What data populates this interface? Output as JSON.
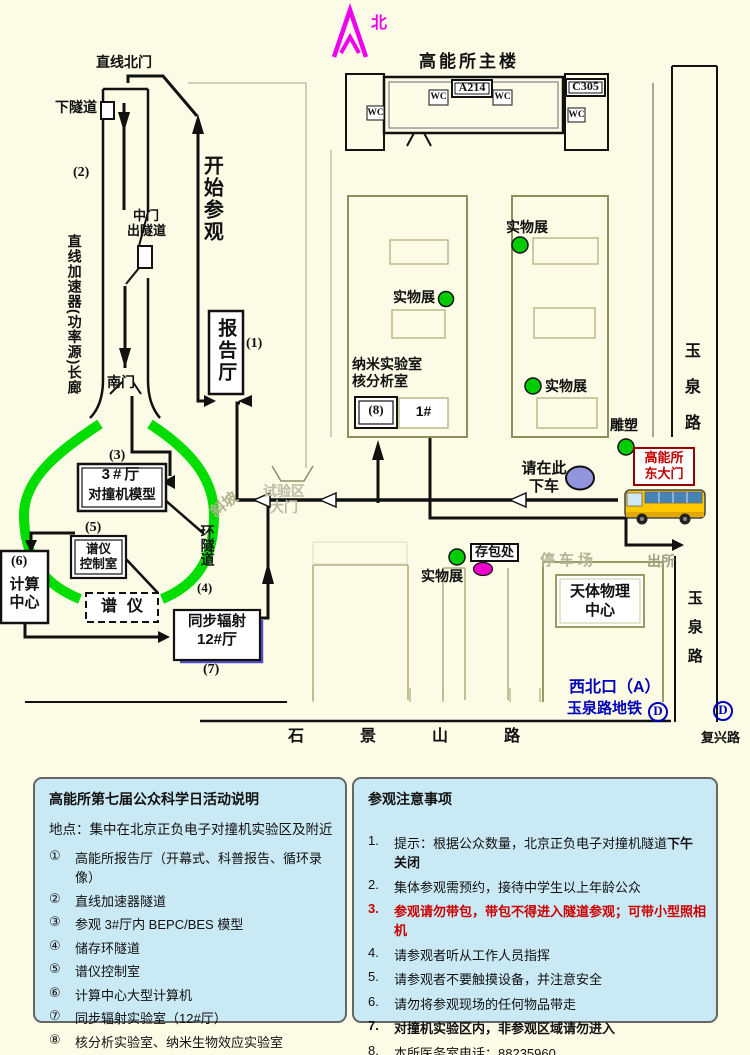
{
  "map": {
    "north": "北",
    "main_building": {
      "title": "高能所主楼",
      "a214": "A214",
      "c305": "C305",
      "wc": "WC"
    },
    "labels": {
      "line_north_gate": "直线北门",
      "down_tunnel": "下隧道",
      "n1": "(1)",
      "n2": "(2)",
      "n3": "(3)",
      "n4": "(4)",
      "n5": "(5)",
      "n6": "(6)",
      "n7": "(7)",
      "n8": "(8)",
      "linac": "直线加速器(功率源)长廊",
      "mid_gate_1": "中门",
      "mid_gate_2": "出隧道",
      "start_visit": "开始参观",
      "south_gate": "南门",
      "report_hall": "报告厅",
      "hall3_1": "3#厅",
      "hall3_2": "对撞机模型",
      "spectro_ctrl_1": "谱仪",
      "spectro_ctrl_2": "控制室",
      "computing_1": "计算",
      "computing_2": "中心",
      "spectrometer": "谱仪",
      "ring_tunnel": "环隧道",
      "sync_1": "同步辐射",
      "sync_2": "12#厅",
      "slope": "斜坡",
      "test_gate_1": "试验区",
      "test_gate_2": "大门",
      "nano_1": "纳米实验室",
      "nano_2": "核分析室",
      "hall_1no": "1#",
      "exhibit": "实物展",
      "sculpture": "雕塑",
      "east_gate_1": "高能所",
      "east_gate_2": "东大门",
      "get_off_1": "请在此",
      "get_off_2": "下车",
      "parking": "停车场",
      "bag_check": "存包处",
      "astro_1": "天体物理",
      "astro_2": "中心",
      "exit_out": "出所",
      "northwest_exit": "西北口（A）",
      "subway": "玉泉路地铁",
      "subway_d": "D",
      "yuquan_road": "玉泉路",
      "shijingshan_road": "石景山路",
      "fuxing_road": "复兴路"
    },
    "colors": {
      "ring_green": "#00DD00",
      "marker_green": "#00CC00",
      "bag_magenta": "#EE00CC",
      "dropoff_blue": "#9394DE",
      "north_magenta": "#EE00EE",
      "bus_yellow": "#FFC800",
      "subway_blue": "#0000BB",
      "east_gate_red": "#CC0000",
      "panel_blue": "#C9E9F4"
    }
  },
  "legend_left": {
    "title": "高能所第七届公众科学日活动说明",
    "location": "地点：集中在北京正负电子对撞机实验区及附近",
    "items": [
      {
        "num": "①",
        "text": "高能所报告厅（开幕式、科普报告、循环录像）"
      },
      {
        "num": "②",
        "text": "直线加速器隧道"
      },
      {
        "num": "③",
        "text": "参观 3#厅内 BEPC/BES 模型"
      },
      {
        "num": "④",
        "text": "储存环隧道"
      },
      {
        "num": "⑤",
        "text": "谱仪控制室"
      },
      {
        "num": "⑥",
        "text": "计算中心大型计算机"
      },
      {
        "num": "⑦",
        "text": "同步辐射实验室（12#厅）"
      },
      {
        "num": "⑧",
        "text": "核分析实验室、纳米生物效应实验室"
      }
    ]
  },
  "legend_right": {
    "title": "参观注意事项",
    "items": [
      {
        "num": "1.",
        "text": "提示：根据公众数量，北京正负电子对撞机隧道",
        "tail": "下午关闭"
      },
      {
        "num": "2.",
        "text": "集体参观需预约，接待中学生以上年龄公众"
      },
      {
        "num": "3.",
        "text": "参观请勿带包，带包不得进入隧道参观；可带小型照相机"
      },
      {
        "num": "4.",
        "text": "请参观者听从工作人员指挥"
      },
      {
        "num": "5.",
        "text": "请参观者不要触摸设备，并注意安全"
      },
      {
        "num": "6.",
        "text": "请勿将参观现场的任何物品带走"
      },
      {
        "num": "7.",
        "text": "对撞机实验区内，非参观区域请勿进入"
      },
      {
        "num": "8.",
        "text": "本所医务室电话：88235960"
      }
    ]
  }
}
